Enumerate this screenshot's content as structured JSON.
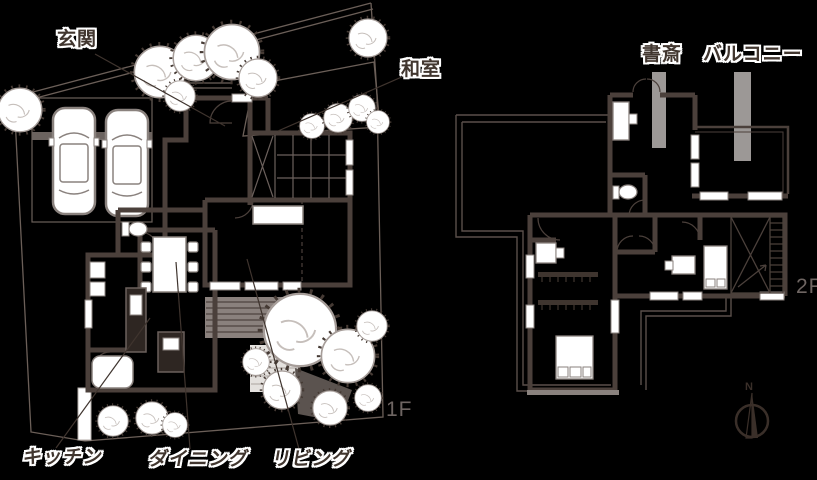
{
  "page": {
    "background": "#000000"
  },
  "floor1": {
    "floor_label": "1F",
    "labels": {
      "entrance": "玄関",
      "japanese_room": "和室",
      "kitchen": "キッチン",
      "dining": "ダイニング",
      "living": "リビング"
    }
  },
  "floor2": {
    "floor_label": "2F",
    "labels": {
      "study": "書斎",
      "balcony": "バルコニー"
    }
  },
  "compass": {
    "north_label": "N"
  },
  "colors": {
    "background": "#000000",
    "wall": "#4b403b",
    "line_dark": "#3f342e",
    "light_gray": "#9c9896",
    "deck_gray": "#8a817d",
    "label_text": "#41362f",
    "floor_label_text": "#6e6562",
    "white": "#ffffff"
  }
}
